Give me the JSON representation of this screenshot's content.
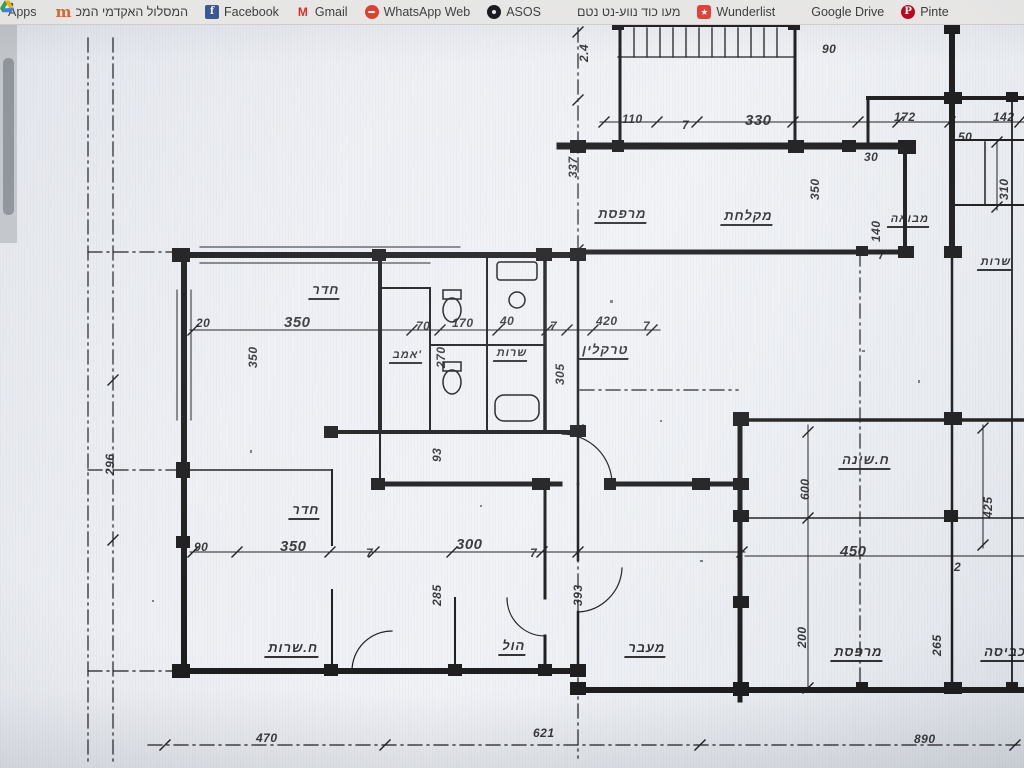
{
  "bookmarks_bar": {
    "apps_label": "Apps",
    "items": [
      {
        "label": "המסלול האקדמי המכ",
        "icon": "college"
      },
      {
        "label": "Facebook",
        "icon": "facebook"
      },
      {
        "label": "Gmail",
        "icon": "gmail"
      },
      {
        "label": "WhatsApp Web",
        "icon": "whatsapp"
      },
      {
        "label": "ASOS",
        "icon": "asos"
      },
      {
        "label": "מעו כוד נווע-נט נטם",
        "icon": "dots"
      },
      {
        "label": "Wunderlist",
        "icon": "wunderlist"
      },
      {
        "label": "Google Drive",
        "icon": "google-drive"
      },
      {
        "label": "Pinte",
        "icon": "pinterest"
      }
    ]
  },
  "icons": {
    "college_glyph": "m",
    "facebook_glyph": "f",
    "gmail_glyph": "M",
    "wunderlist_glyph": "★",
    "pinterest_glyph": "P"
  },
  "colors": {
    "ink": "#1d1d20",
    "paper": "#edeff4",
    "bar_bg": "#f3f2f0",
    "accent_orange": "#e2692b"
  },
  "plan": {
    "description": "scanned architectural floor plan, hand-lettered Hebrew room names and dimensions",
    "labels": [
      {
        "text": "20",
        "x": 196,
        "y": 316,
        "type": "dim"
      },
      {
        "text": "350",
        "x": 284,
        "y": 314,
        "type": "dim",
        "fs": 15
      },
      {
        "text": "70",
        "x": 416,
        "y": 319,
        "type": "dim"
      },
      {
        "text": "170",
        "x": 452,
        "y": 316,
        "type": "dim"
      },
      {
        "text": "40",
        "x": 500,
        "y": 314,
        "type": "dim"
      },
      {
        "text": "7",
        "x": 550,
        "y": 319,
        "type": "dim"
      },
      {
        "text": "420",
        "x": 596,
        "y": 314,
        "type": "dim"
      },
      {
        "text": "7",
        "x": 643,
        "y": 319,
        "type": "dim"
      },
      {
        "text": "350",
        "x": 246,
        "y": 368,
        "type": "dim",
        "rot": -90
      },
      {
        "text": "270",
        "x": 434,
        "y": 368,
        "type": "dim",
        "rot": -90
      },
      {
        "text": "305",
        "x": 553,
        "y": 385,
        "type": "dim",
        "rot": -90
      },
      {
        "text": "2.4",
        "x": 577,
        "y": 62,
        "type": "dim",
        "rot": -90
      },
      {
        "text": "337",
        "x": 566,
        "y": 178,
        "type": "dim",
        "rot": -90
      },
      {
        "text": "110",
        "x": 622,
        "y": 112,
        "type": "dim"
      },
      {
        "text": "7",
        "x": 682,
        "y": 118,
        "type": "dim"
      },
      {
        "text": "330",
        "x": 745,
        "y": 112,
        "type": "dim",
        "fs": 15
      },
      {
        "text": "90",
        "x": 822,
        "y": 42,
        "type": "dim"
      },
      {
        "text": "350",
        "x": 808,
        "y": 200,
        "type": "dim",
        "rot": -90
      },
      {
        "text": "140",
        "x": 869,
        "y": 242,
        "type": "dim",
        "rot": -90
      },
      {
        "text": "7",
        "x": 878,
        "y": 248,
        "type": "dim"
      },
      {
        "text": "172",
        "x": 894,
        "y": 110,
        "type": "dim"
      },
      {
        "text": "30",
        "x": 864,
        "y": 150,
        "type": "dim"
      },
      {
        "text": "50",
        "x": 958,
        "y": 130,
        "type": "dim"
      },
      {
        "text": "142",
        "x": 993,
        "y": 110,
        "type": "dim"
      },
      {
        "text": "310",
        "x": 997,
        "y": 200,
        "type": "dim",
        "rot": -90
      },
      {
        "text": "93",
        "x": 430,
        "y": 462,
        "type": "dim",
        "rot": -90
      },
      {
        "text": "90",
        "x": 194,
        "y": 540,
        "type": "dim"
      },
      {
        "text": "350",
        "x": 280,
        "y": 538,
        "type": "dim",
        "fs": 15
      },
      {
        "text": "7",
        "x": 366,
        "y": 546,
        "type": "dim"
      },
      {
        "text": "300",
        "x": 456,
        "y": 536,
        "type": "dim",
        "fs": 15
      },
      {
        "text": "7",
        "x": 530,
        "y": 546,
        "type": "dim"
      },
      {
        "text": "285",
        "x": 430,
        "y": 606,
        "type": "dim",
        "rot": -90
      },
      {
        "text": "393",
        "x": 571,
        "y": 606,
        "type": "dim",
        "rot": -90
      },
      {
        "text": "600",
        "x": 798,
        "y": 500,
        "type": "dim",
        "rot": -90
      },
      {
        "text": "450",
        "x": 840,
        "y": 543,
        "type": "dim",
        "fs": 15
      },
      {
        "text": "2",
        "x": 954,
        "y": 560,
        "type": "dim"
      },
      {
        "text": "425",
        "x": 981,
        "y": 518,
        "type": "dim",
        "rot": -90
      },
      {
        "text": "200",
        "x": 795,
        "y": 648,
        "type": "dim",
        "rot": -90
      },
      {
        "text": "265",
        "x": 930,
        "y": 656,
        "type": "dim",
        "rot": -90
      },
      {
        "text": "470",
        "x": 256,
        "y": 731,
        "type": "dim"
      },
      {
        "text": "621",
        "x": 533,
        "y": 726,
        "type": "dim"
      },
      {
        "text": "890",
        "x": 914,
        "y": 732,
        "type": "dim"
      },
      {
        "text": "296",
        "x": 103,
        "y": 475,
        "type": "dim",
        "rot": -90
      },
      {
        "text": "חדר",
        "x": 312,
        "y": 282,
        "type": "room"
      },
      {
        "text": "אמב'",
        "x": 392,
        "y": 349,
        "type": "room",
        "fs": 11
      },
      {
        "text": "שרות",
        "x": 496,
        "y": 347,
        "type": "room",
        "fs": 11
      },
      {
        "text": "טרקלין",
        "x": 582,
        "y": 342,
        "type": "room"
      },
      {
        "text": "מרפסת",
        "x": 598,
        "y": 206,
        "type": "room"
      },
      {
        "text": "מקלחת",
        "x": 724,
        "y": 208,
        "type": "room"
      },
      {
        "text": "מבואה",
        "x": 890,
        "y": 213,
        "type": "room",
        "fs": 11
      },
      {
        "text": "שרות",
        "x": 980,
        "y": 256,
        "type": "room",
        "fs": 11
      },
      {
        "text": "חדר",
        "x": 292,
        "y": 502,
        "type": "room"
      },
      {
        "text": "ח.שינה",
        "x": 842,
        "y": 452,
        "type": "room"
      },
      {
        "text": "ח.שרות",
        "x": 268,
        "y": 640,
        "type": "room"
      },
      {
        "text": "הול",
        "x": 502,
        "y": 638,
        "type": "room"
      },
      {
        "text": "מעבר",
        "x": 628,
        "y": 640,
        "type": "room"
      },
      {
        "text": "מרפסת",
        "x": 834,
        "y": 644,
        "type": "room"
      },
      {
        "text": "כביסה",
        "x": 984,
        "y": 644,
        "type": "room"
      }
    ]
  }
}
